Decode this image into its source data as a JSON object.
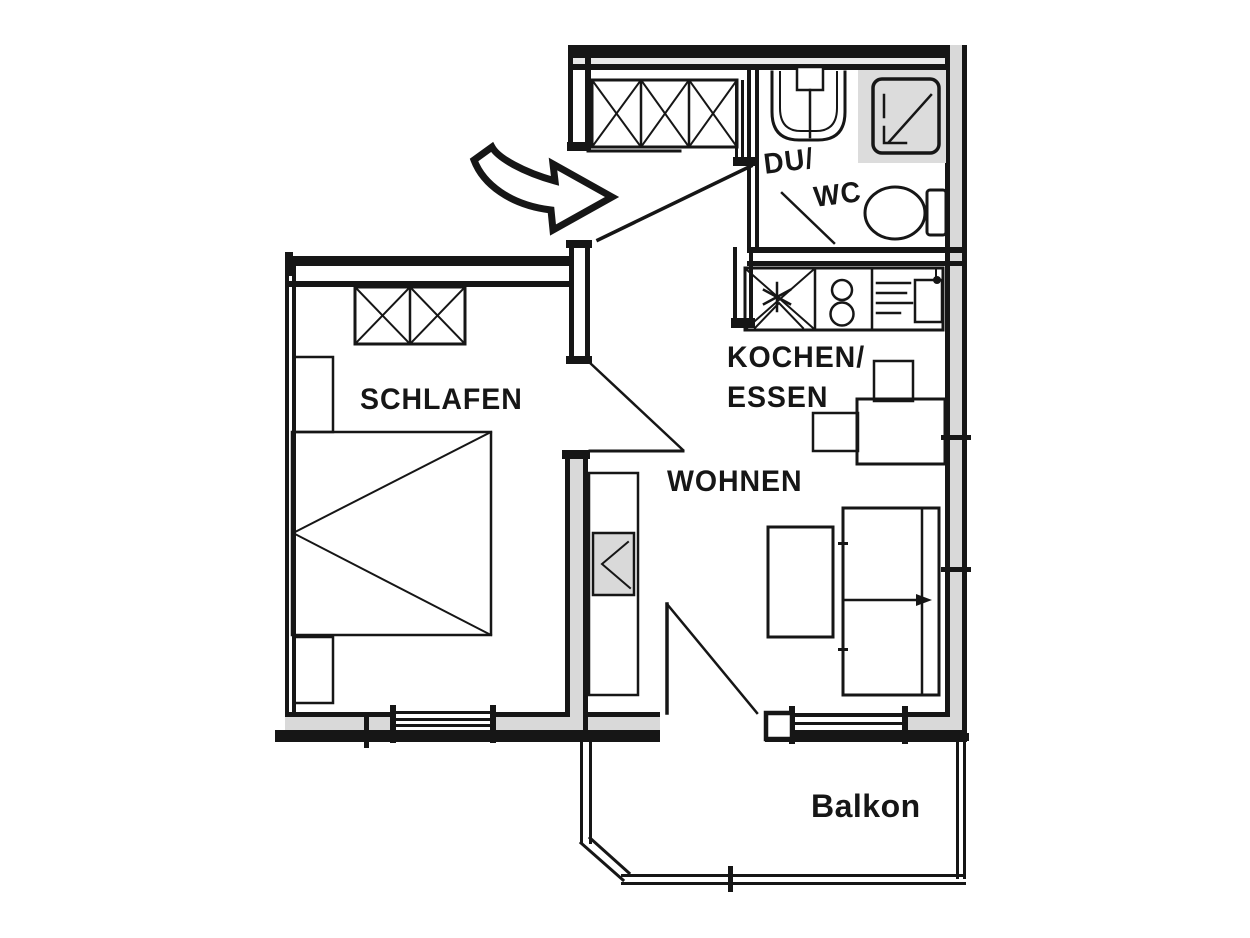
{
  "floor_plan": {
    "background_color": "#ffffff",
    "ink_color": "#161616",
    "wall_fill_color": "#d9d9d9",
    "shower_niche_color": "#dcdcdc",
    "tv_fill_color": "#d9d9d9",
    "rooms": {
      "bedroom": {
        "label": "SCHLAFEN"
      },
      "living_room": {
        "label": "WOHNEN"
      },
      "kitchen_dining": {
        "line1": "KOCHEN/",
        "line2": "ESSEN"
      },
      "shower_wc": {
        "line1": "DU/",
        "line2": "WC"
      },
      "balcony": {
        "label": "Balkon"
      }
    },
    "icons": [
      "entrance-arrow",
      "hall-wardrobe",
      "bedroom-wardrobe",
      "bed",
      "nightstand",
      "tv-cabinet",
      "coffee-table",
      "sofa",
      "dining-table",
      "dining-chair",
      "kitchen-counter",
      "stove",
      "kitchen-sink",
      "washbasin",
      "shower",
      "toilet",
      "window",
      "door-swing",
      "balcony-railing"
    ]
  }
}
